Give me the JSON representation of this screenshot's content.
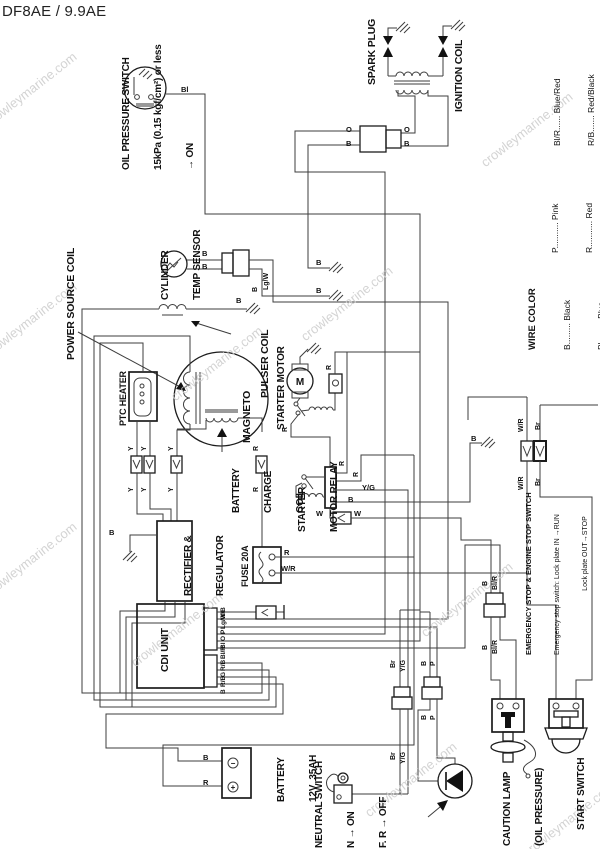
{
  "title": "DF8AE / 9.9AE",
  "watermark": "crowleymarine.com",
  "legend": {
    "heading": "WIRE COLOR",
    "group1": [
      "B......... Black",
      "Bl......... Blue",
      "Br........ Brown",
      "G......... Green",
      "O......... Orange"
    ],
    "group2": [
      "P........... Pink",
      "R........... Red",
      "W.......... White",
      "Y........... Yellow",
      "B/R...... Black/Red"
    ],
    "group3": [
      "Bl/R...... Blue/Red",
      "R/B....... Red/Black",
      "W/R...... White/Red",
      "Y/B....... Yellow/Black",
      "Y/G...... Yellow/Green",
      "Lg/W.... Light green/White"
    ]
  },
  "components": {
    "oil_pressure_switch": {
      "l1": "OIL PRESSURE SWITCH",
      "l2": "15kPa (0.15 kgf/cm²) or less",
      "l3": "→ ON"
    },
    "spark_plug": "SPARK PLUG",
    "ignition_coil": "IGNITION COIL",
    "power_source_coil": "POWER SOURCE COIL",
    "cylinder_temp_sensor": {
      "l1": "CYLINDER",
      "l2": "TEMP SENSOR"
    },
    "pulser_coil": "PULSER COIL",
    "magneto": "MAGNETO",
    "starter_motor": "STARTER MOTOR",
    "ptc_heater": "PTC HEATER",
    "battery_charge_coil": {
      "l1": "BATTERY",
      "l2": "CHARGE",
      "l3": "COIL"
    },
    "starter_motor_relay": {
      "l1": "STARTER",
      "l2": "MOTOR RELAY"
    },
    "rectifier_regulator": {
      "l1": "RECTIFIER &",
      "l2": "REGULATOR"
    },
    "fuse": "FUSE 20A",
    "cdi_unit": "CDI UNIT",
    "battery": {
      "l1": "BATTERY",
      "l2": "12V  35AH"
    },
    "neutral_switch": {
      "l1": "NEUTRAL SWITCH",
      "l2": "N → ON",
      "l3": "F. R → OFF"
    },
    "caution_lamp": {
      "l1": "CAUTION LAMP",
      "l2": "(OIL PRESSURE)"
    },
    "start_switch": {
      "l1": "START SWITCH",
      "l2": "PUSH → START"
    },
    "emergency_stop_switch": {
      "l1": "EMERGENCY STOP & ENGINE STOP SWITCH",
      "l2": "Emergency stop switch: Lock plate IN →RUN",
      "l3": "                                 Lock plate OUT→STOP",
      "l4": "Engine stop switch:     Button pushed →STOP"
    }
  },
  "codes": {
    "b": "B",
    "bl": "Bl",
    "br": "Br",
    "o": "O",
    "p": "P",
    "r": "R",
    "w": "W",
    "y": "Y",
    "g": "G",
    "yg": "Y/G",
    "yb": "Y/B",
    "wr": "W/R",
    "lgw": "Lg/W",
    "blr": "Bl/R",
    "rb": "R/B",
    "m": "M",
    "minus": "−",
    "plus": "+"
  }
}
